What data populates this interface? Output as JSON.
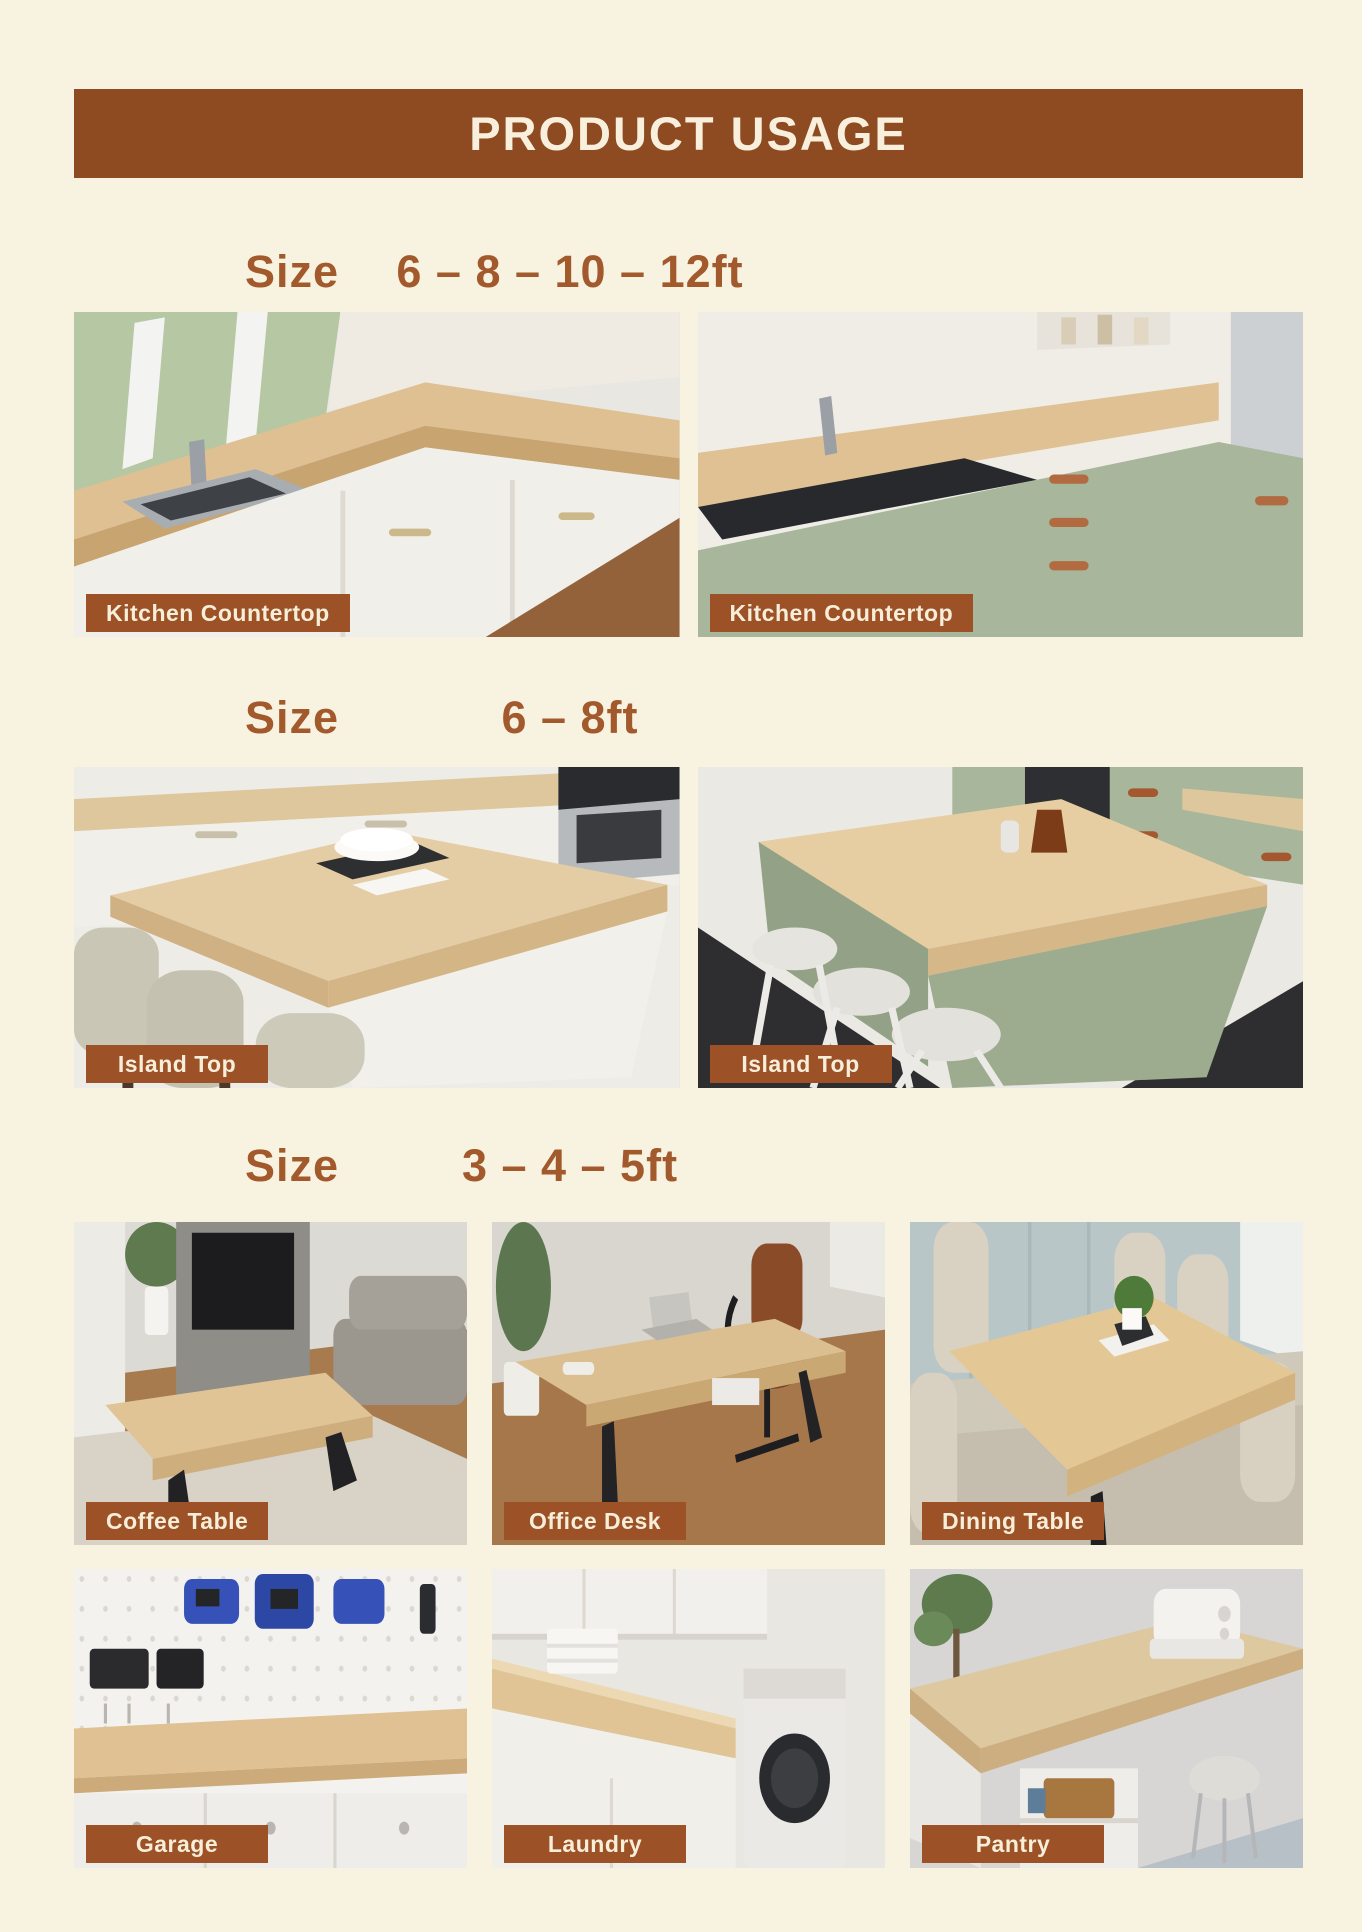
{
  "header": {
    "title": "PRODUCT USAGE"
  },
  "sections": [
    {
      "size_label": "Size",
      "size_value": "6 – 8 – 10 – 12ft",
      "items": [
        {
          "label": "Kitchen Countertop"
        },
        {
          "label": "Kitchen Countertop"
        }
      ]
    },
    {
      "size_label": "Size",
      "size_value": "6 – 8ft",
      "items": [
        {
          "label": "Island Top"
        },
        {
          "label": "Island Top"
        }
      ]
    },
    {
      "size_label": "Size",
      "size_value": "3 – 4 – 5ft",
      "items": [
        {
          "label": "Coffee Table"
        },
        {
          "label": "Office Desk"
        },
        {
          "label": "Dining Table"
        },
        {
          "label": "Garage"
        },
        {
          "label": "Laundry"
        },
        {
          "label": "Pantry"
        }
      ]
    }
  ],
  "colors": {
    "background": "#f8f2e1",
    "banner": "#8e4a20",
    "badge": "#9c5126",
    "heading_text": "#a2592c",
    "banner_text": "#f8f0dc",
    "badge_text": "#f7eeda"
  }
}
